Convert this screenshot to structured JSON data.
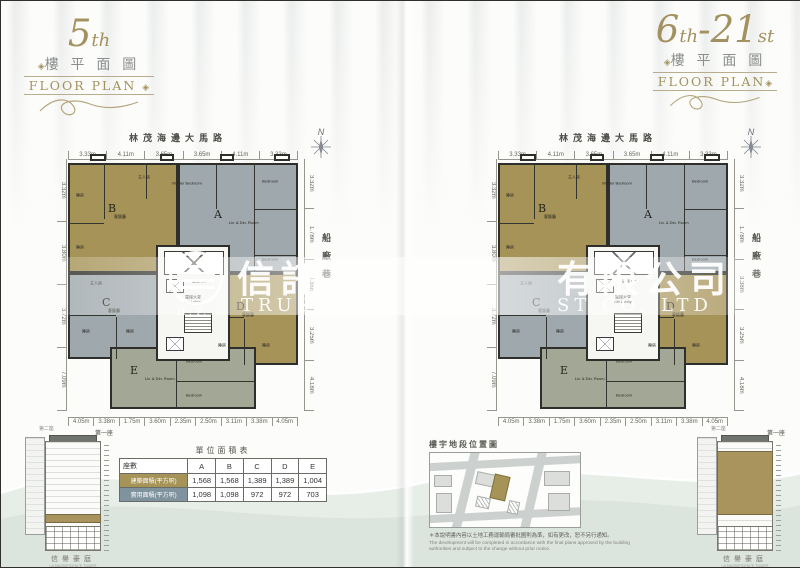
{
  "titles": {
    "ornament": "◈",
    "left": {
      "n1": "5",
      "s1": "th",
      "n2": "",
      "s2": "",
      "cn": "樓 平 面 圖",
      "en": "FLOOR PLAN"
    },
    "right": {
      "n1": "6",
      "s1": "th",
      "n2": "-21",
      "s2": "st",
      "cn": "樓 平 面 圖",
      "en": "FLOOR PLAN"
    }
  },
  "plan": {
    "street": "林茂海邊大馬路",
    "lane": "船廠巷",
    "compass_n": "N",
    "units": {
      "a": {
        "letter": "A",
        "sub": "Liv. & Din. Room"
      },
      "b": {
        "letter": "B",
        "sub": "客飯廳"
      },
      "c": {
        "letter": "C",
        "sub": "客飯廳"
      },
      "d": {
        "letter": "D",
        "sub": "客飯廳"
      },
      "e": {
        "letter": "E",
        "sub": "Liv. & Din. Room"
      }
    },
    "rooms": {
      "master_cn": "主人房",
      "master_en": "Master Bedroom",
      "bedroom_en": "Bedroom",
      "bedroom_cn": "睡房",
      "lift_lobby": "電梯大堂",
      "lift_lobby_en": "Lift Lobby",
      "lift": "電梯",
      "lift_en": "Lift"
    },
    "dims": {
      "top": [
        "3.33m",
        "4.11m",
        "3.65m",
        "3.65m",
        "4.11m",
        "3.33m"
      ],
      "bottom": [
        "4.05m",
        "3.38m",
        "1.75m",
        "3.60m",
        "2.35m",
        "2.50m",
        "3.11m",
        "3.38m",
        "4.05m"
      ],
      "right": [
        "3.32m",
        "1.78m",
        "3.38m",
        "3.25m",
        "4.18m"
      ],
      "left": [
        "3.32m",
        "3.80m",
        "3.72m",
        "7.09m"
      ]
    }
  },
  "area_table": {
    "title": "單位面積表",
    "col_header": "座數",
    "columns": [
      "A",
      "B",
      "C",
      "D",
      "E"
    ],
    "rows": [
      {
        "label": "建築面積(平方呎)",
        "values": [
          "1,568",
          "1,568",
          "1,389",
          "1,389",
          "1,004"
        ]
      },
      {
        "label": "實用面積(平方呎)",
        "values": [
          "1,098",
          "1,098",
          "972",
          "972",
          "703"
        ]
      }
    ]
  },
  "location_map": {
    "title": "樓宇地段位置圖",
    "disclaimer_cn": "＊本說明書內容以土地工務運輸局審批圖則為準，如有更改，恕不另行通知。",
    "disclaimer_en": "The development will be completed in accordance with the final plans approved by the building authorities and subject to the change without prior notice."
  },
  "elevation": {
    "tower_front": "第一座",
    "tower_back": "第二座",
    "name_cn": "信譽豪庭",
    "name_en": "LA MAGNIFICENCE TOWER"
  },
  "watermark": {
    "cn_left": "信託",
    "cn_right": "有限公司",
    "en_left": "TRUS",
    "en_right": "ST CO. LTD",
    "monogram": "H.T."
  },
  "colors": {
    "tan": "#a69357",
    "gray": "#9fa8ac",
    "sage": "#a3a896",
    "wall": "#2e2e2a",
    "accent": "#a39260"
  }
}
